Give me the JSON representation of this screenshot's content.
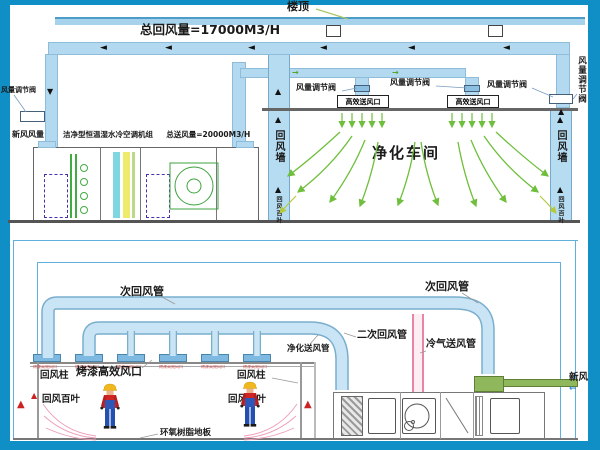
{
  "top": {
    "roof": "楼顶",
    "total_return": "总回风量=17000M3/H",
    "valve": "风量调节阀",
    "fresh_air": "新风风量",
    "ahu_name": "洁净型恒温湿水冷空调机组",
    "total_supply": "总送风量=20000M3/H",
    "hepa_outlet": "高效送风口",
    "workshop": "净化车间",
    "return_wall": "回风墙",
    "return_louver": "回风百叶"
  },
  "bottom": {
    "secondary_return": "次回风管",
    "second_stage_return": "二次回风管",
    "purified_supply": "净化送风管",
    "cold_air_supply": "冷气送风管",
    "fresh_air": "新风",
    "return_column": "回风柱",
    "baked_hepa_outlet": "烤漆高效风口",
    "return_louver": "回风百叶",
    "epoxy_floor": "环氧树脂地板",
    "diffuser_tag": "烤漆高效风口"
  },
  "icons": {
    "arrow_left": "◄",
    "arrow_up": "▲",
    "arrow_down": "▼",
    "arrow_right": "→",
    "fresh_in_arrow": "←"
  },
  "colors": {
    "frame_blue": "#0f8fc5",
    "duct_fill": "#b2d9ef",
    "duct_edge": "#79aecd",
    "flow_green": "#6fbf3c",
    "cold_pink": "#e884a4",
    "fresh_green": "#8fb85c",
    "alert_red": "#cc2222"
  }
}
